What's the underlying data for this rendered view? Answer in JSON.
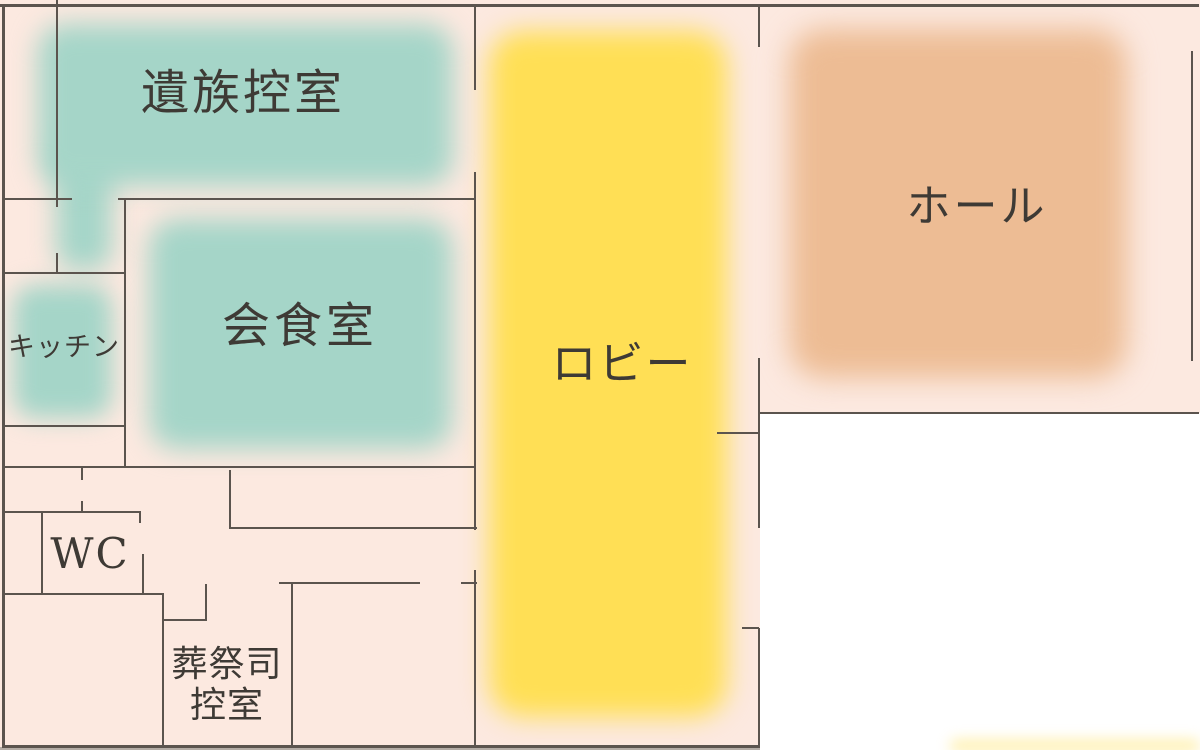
{
  "title": "funeral-hall-floor-plan",
  "colors": {
    "bg": "#fce9e0",
    "outside": "#ffffff",
    "wall": "#5b544e",
    "teal": "#a5d5c8",
    "yellow": "#ffdf55",
    "orange": "#edbc94",
    "text": "#3e3a35",
    "strip": "#b3aca5"
  },
  "rooms": {
    "izoku": {
      "label": "遺族控室"
    },
    "kaishoku": {
      "label": "会食室"
    },
    "kitchen": {
      "label": "キッチン"
    },
    "wc": {
      "label": "WC"
    },
    "sousaishi": {
      "label_line1": "葬祭司",
      "label_line2": "控室"
    },
    "lobby": {
      "label": "ロビー"
    },
    "hall": {
      "label": "ホール"
    }
  },
  "floorplan": {
    "blobs": [
      {
        "name": "izoku-room-area",
        "color": "teal",
        "x": 38,
        "y": 24,
        "w": 415,
        "h": 162,
        "r": 28,
        "blur": 13
      },
      {
        "name": "izoku-corridor-area",
        "color": "teal",
        "x": 56,
        "y": 140,
        "w": 56,
        "h": 130,
        "r": 20,
        "blur": 13
      },
      {
        "name": "kitchen-area",
        "color": "teal",
        "x": 13,
        "y": 285,
        "w": 99,
        "h": 133,
        "r": 22,
        "blur": 12
      },
      {
        "name": "kaishoku-area",
        "color": "teal",
        "x": 149,
        "y": 219,
        "w": 303,
        "h": 230,
        "r": 28,
        "blur": 13
      },
      {
        "name": "lobby-area",
        "color": "yellow",
        "x": 489,
        "y": 31,
        "w": 238,
        "h": 686,
        "r": 34,
        "blur": 13
      },
      {
        "name": "hall-area",
        "color": "orange",
        "x": 789,
        "y": 29,
        "w": 338,
        "h": 349,
        "r": 34,
        "blur": 14
      },
      {
        "name": "bottom-right-glow",
        "color": "yellow",
        "x": 950,
        "y": 740,
        "w": 250,
        "h": 12,
        "r": 6,
        "blur": 7,
        "opacity": 0.5
      }
    ],
    "walls": [
      {
        "x": 0,
        "y": 4,
        "w": 1199,
        "h": 2.5
      },
      {
        "x": 2,
        "y": 4,
        "w": 2.5,
        "h": 743
      },
      {
        "x": 2,
        "y": 745,
        "w": 758,
        "h": 2.5
      },
      {
        "x": 1191,
        "y": 51,
        "w": 2,
        "h": 310
      },
      {
        "x": 759,
        "y": 412,
        "w": 440,
        "h": 2
      },
      {
        "x": 56,
        "y": 0,
        "w": 2,
        "h": 207
      },
      {
        "x": 2,
        "y": 198,
        "w": 70,
        "h": 2
      },
      {
        "x": 56,
        "y": 253,
        "w": 2,
        "h": 21
      },
      {
        "x": 2,
        "y": 272,
        "w": 124,
        "h": 2
      },
      {
        "x": 2,
        "y": 425,
        "w": 124,
        "h": 2
      },
      {
        "x": 124,
        "y": 198,
        "w": 2,
        "h": 270
      },
      {
        "x": 118,
        "y": 198,
        "w": 358,
        "h": 2
      },
      {
        "x": 2,
        "y": 466,
        "w": 474,
        "h": 2
      },
      {
        "x": 229,
        "y": 470,
        "w": 2,
        "h": 59
      },
      {
        "x": 229,
        "y": 527,
        "w": 248,
        "h": 2
      },
      {
        "x": 81,
        "y": 466,
        "w": 2,
        "h": 14
      },
      {
        "x": 81,
        "y": 501,
        "w": 2,
        "h": 12
      },
      {
        "x": 2,
        "y": 511,
        "w": 139,
        "h": 2
      },
      {
        "x": 139,
        "y": 511,
        "w": 2,
        "h": 12
      },
      {
        "x": 142,
        "y": 554,
        "w": 2,
        "h": 41
      },
      {
        "x": 41,
        "y": 511,
        "w": 2,
        "h": 84
      },
      {
        "x": 2,
        "y": 593,
        "w": 162,
        "h": 2
      },
      {
        "x": 162,
        "y": 593,
        "w": 2,
        "h": 154
      },
      {
        "x": 162,
        "y": 619,
        "w": 45,
        "h": 2
      },
      {
        "x": 205,
        "y": 584,
        "w": 2,
        "h": 37
      },
      {
        "x": 279,
        "y": 582,
        "w": 141,
        "h": 2
      },
      {
        "x": 461,
        "y": 582,
        "w": 16,
        "h": 2
      },
      {
        "x": 291,
        "y": 582,
        "w": 2,
        "h": 165
      },
      {
        "x": 474,
        "y": 4,
        "w": 2,
        "h": 86
      },
      {
        "x": 474,
        "y": 172,
        "w": 2,
        "h": 358
      },
      {
        "x": 474,
        "y": 570,
        "w": 2,
        "h": 177
      },
      {
        "x": 758,
        "y": 4,
        "w": 2,
        "h": 43
      },
      {
        "x": 758,
        "y": 358,
        "w": 2,
        "h": 170
      },
      {
        "x": 758,
        "y": 628,
        "w": 2,
        "h": 119
      },
      {
        "x": 717,
        "y": 432,
        "w": 42,
        "h": 2
      },
      {
        "x": 742,
        "y": 627,
        "w": 17,
        "h": 2
      }
    ]
  }
}
